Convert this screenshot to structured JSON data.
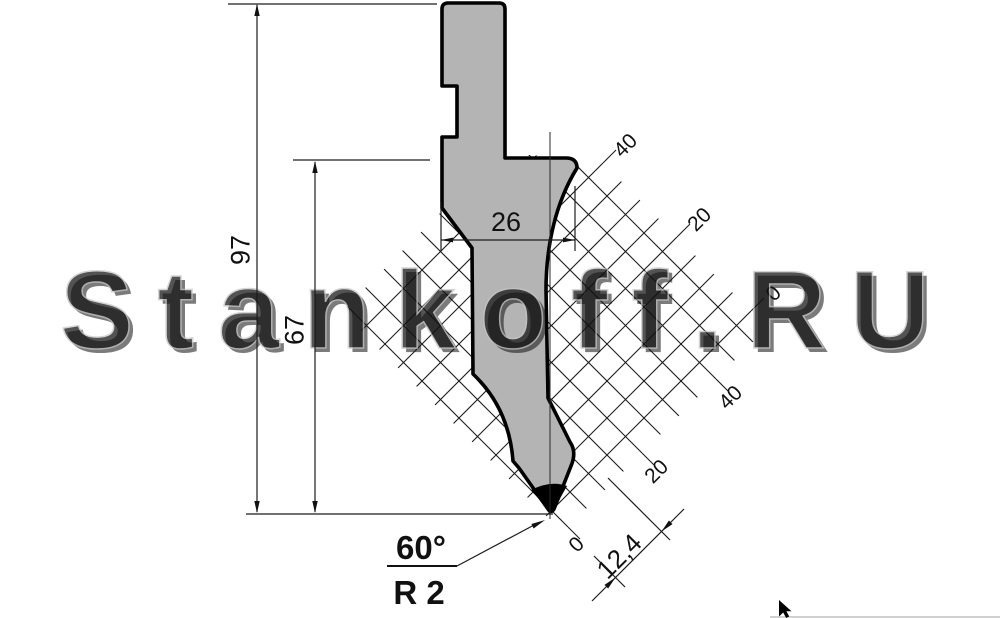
{
  "drawing": {
    "watermark": "Stankoff.RU",
    "dimensions": {
      "total_height": "97",
      "working_height": "67",
      "body_width": "26",
      "tip_offset": "12,4",
      "tip_angle": "60°",
      "tip_radius": "R 2"
    },
    "ruler_upper": [
      "40",
      "20",
      "0"
    ],
    "ruler_lower": [
      "40",
      "20",
      "0"
    ],
    "colors": {
      "body_fill": "#b4b4b4",
      "line": "#111111"
    }
  }
}
